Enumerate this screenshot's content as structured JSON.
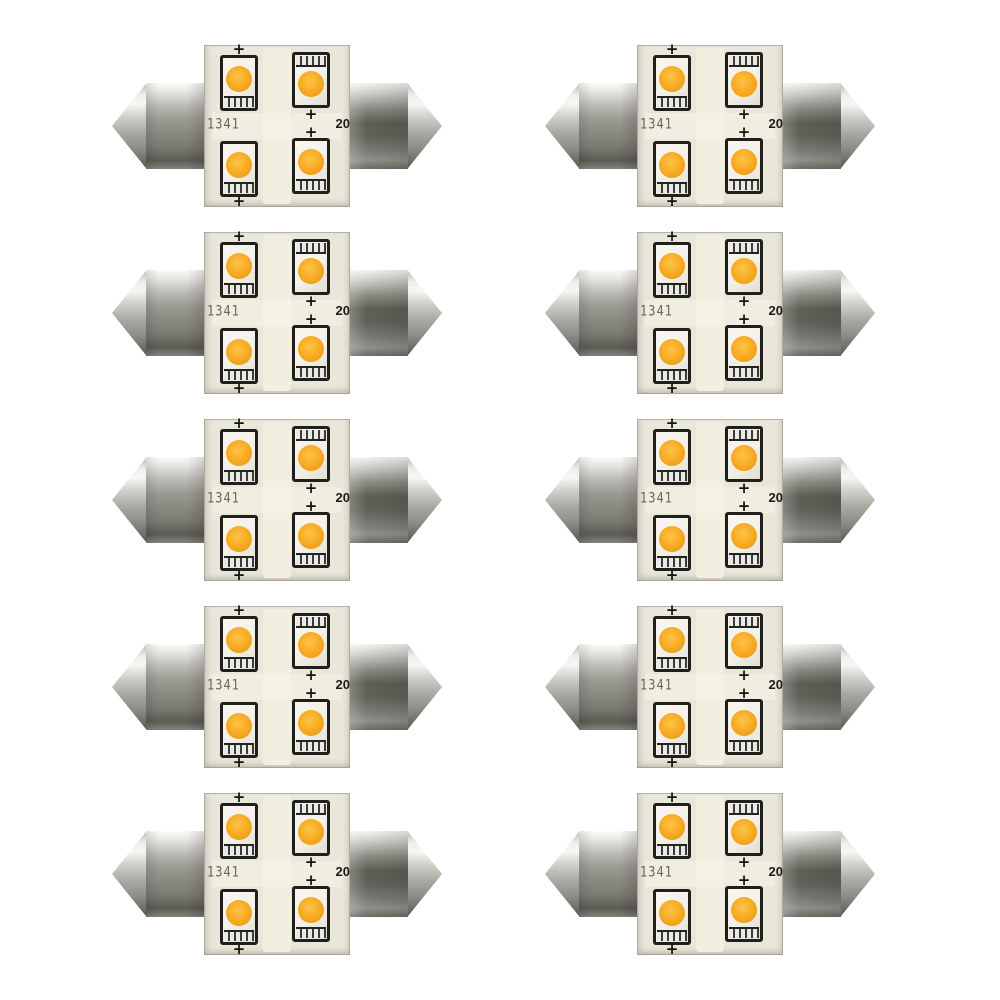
{
  "scene": {
    "type": "product-photo",
    "description": "Ten identical festoon-style LED bulbs arranged in a 5-row by 2-column grid on a white background. Each bulb has two silver pointed metal end caps and a square circuit board carrying four amber SMD LED chips.",
    "background_color": "#ffffff"
  },
  "grid": {
    "rows": 5,
    "columns": 2,
    "count": 10
  },
  "bulb": {
    "pcb_marking": "1341",
    "pcb_label_right": "20",
    "polarity_mark": "+",
    "led_count": 4,
    "colors": {
      "pcb": "#e9e6da",
      "pcb_trace": "#f2efe1",
      "led_amber": "#f6a81e",
      "led_amber_highlight": "#fdc34a",
      "led_package": "#f2f0e8",
      "chip_outline": "#1f1f1c",
      "metal_highlight": "#f6f6f4",
      "metal_mid": "#97968f",
      "metal_dark": "#55544e"
    }
  }
}
